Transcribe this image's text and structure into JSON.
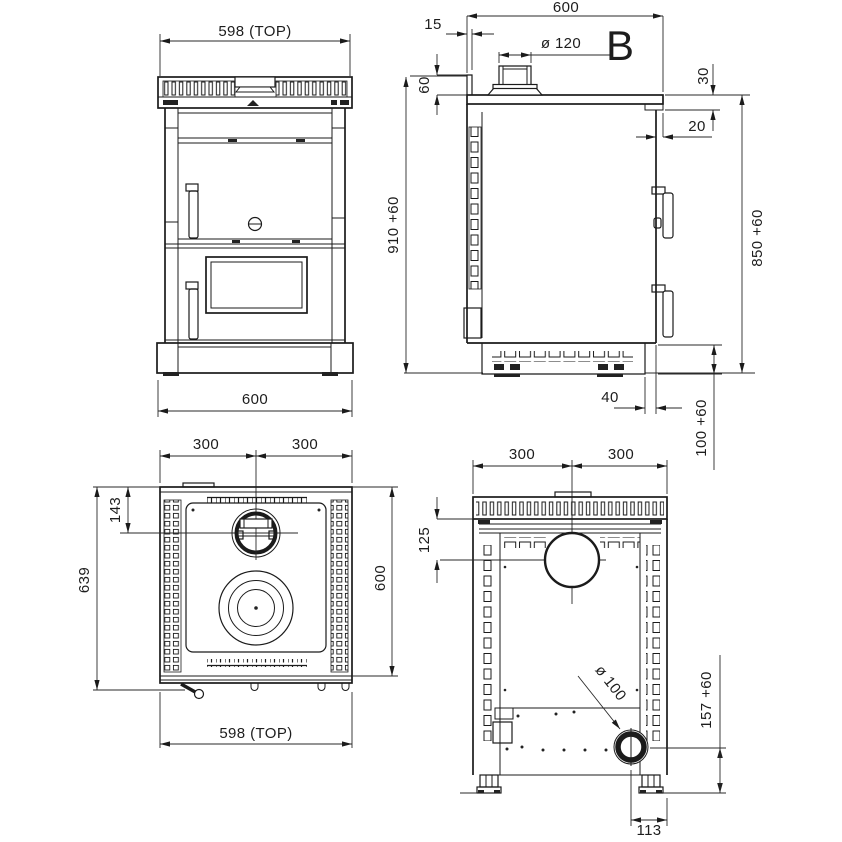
{
  "views": {
    "front": {
      "dim_width_top": "598 (TOP)",
      "dim_width_bottom": "600",
      "dim_total_height": "910 +60"
    },
    "side": {
      "dim_depth": "600",
      "dim_flue_offset": "15",
      "dim_flue_diameter": "ø 120",
      "section_label": "B",
      "dim_upstand_height": "60",
      "dim_top_thickness": "30",
      "dim_worktop_overhang": "20",
      "dim_body_height": "850 +60",
      "dim_plinth_recess": "40",
      "dim_plinth_height": "100 +60"
    },
    "top": {
      "dim_half_left": "300",
      "dim_half_right": "300",
      "dim_flue_from_back": "143",
      "dim_total_depth": "639",
      "dim_depth": "600",
      "dim_width_bottom": "598 (TOP)"
    },
    "rear": {
      "dim_half_left": "300",
      "dim_half_right": "300",
      "dim_flue_from_top": "125",
      "dim_outlet_diameter": "ø 100",
      "dim_outlet_height": "157 +60",
      "dim_outlet_from_side": "113"
    }
  }
}
